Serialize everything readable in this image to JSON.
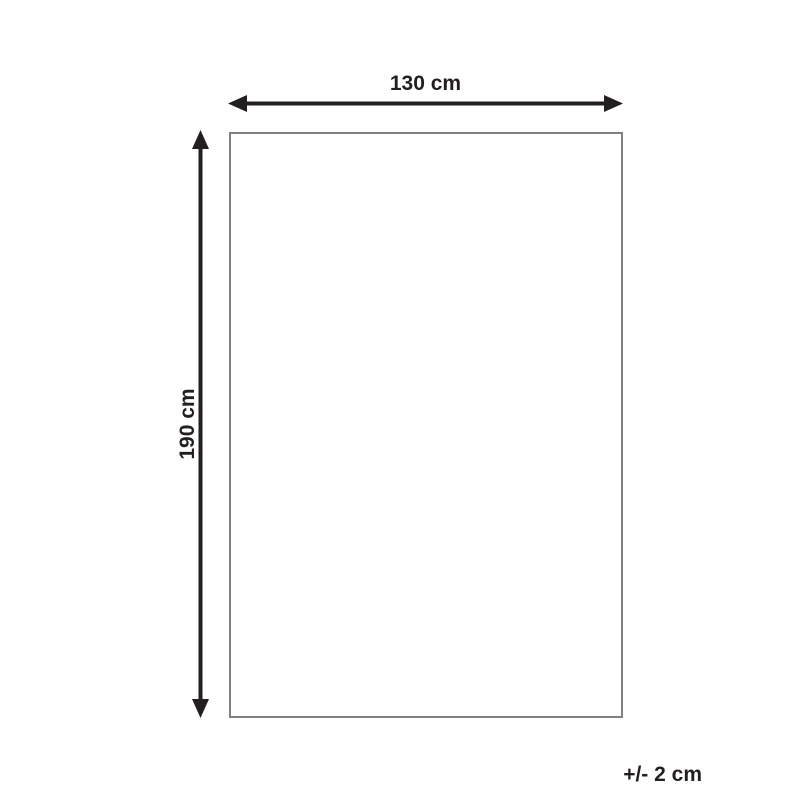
{
  "diagram": {
    "width": {
      "label": "130 cm"
    },
    "height": {
      "label": "190 cm"
    },
    "tolerance": {
      "label": "+/- 2 cm"
    },
    "colors": {
      "arrow": "#231f20",
      "outline": "#808080",
      "background": "#ffffff"
    }
  }
}
